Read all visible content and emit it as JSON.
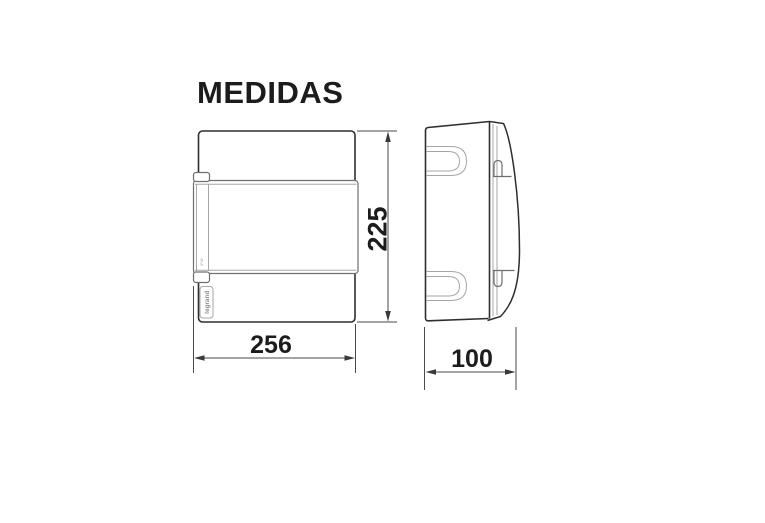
{
  "title": "MEDIDAS",
  "dimensions": {
    "height": "225",
    "width": "256",
    "depth": "100"
  },
  "branding": {
    "logo_text": "legrand",
    "fine_print": "IP40"
  },
  "colors": {
    "background": "#ffffff",
    "line_dark": "#2e2e2e",
    "line_mid": "#6f6f6f",
    "line_light": "#a6a6a6",
    "dimension_line": "#4a4a4a",
    "text": "#1c1c1e"
  }
}
